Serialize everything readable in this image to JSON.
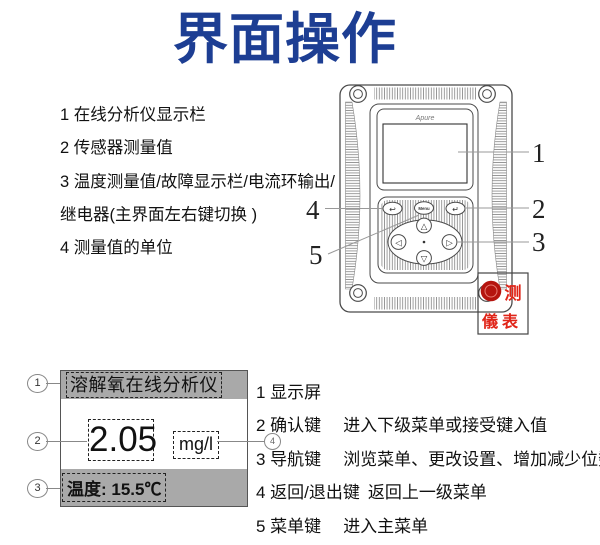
{
  "title": "界面操作",
  "colors": {
    "title_blue": "#1d3e93",
    "bar_gray": "#a9a9a9",
    "watermark_red": "#df2318"
  },
  "intro_list": {
    "items": [
      "1 在线分析仪显示栏",
      "2 传感器测量值",
      "3 温度测量值/故障显示栏/电流环输出/继电器(主界面左右键切换 )",
      "4 测量值的单位"
    ]
  },
  "device": {
    "brand": "Apure",
    "menu_key_label": "Menu",
    "back_icon": "↩",
    "enter_icon": "↵",
    "nav_up_icon": "△",
    "nav_down_icon": "▽",
    "nav_left_icon": "◁",
    "nav_right_icon": "▷",
    "callouts": [
      "1",
      "2",
      "3",
      "4",
      "5"
    ]
  },
  "watermark": {
    "line1": "测",
    "line2": "儀表"
  },
  "screen_mock": {
    "callout_1": "1",
    "callout_2": "2",
    "callout_3": "3",
    "callout_4": "4",
    "header": "溶解氧在线分析仪",
    "value": "2.05",
    "unit": "mg/l",
    "temperature": "温度: 15.5℃"
  },
  "key_list": {
    "rows": [
      {
        "label": "1 显示屏",
        "desc": ""
      },
      {
        "label": "2 确认键",
        "desc": "进入下级菜单或接受键入值"
      },
      {
        "label": "3 导航键",
        "desc": "浏览菜单、更改设置、增加减少位数"
      },
      {
        "label": "4 返回/退出键",
        "desc": "返回上一级菜单"
      },
      {
        "label": "5 菜单键",
        "desc": "进入主菜单"
      }
    ]
  }
}
